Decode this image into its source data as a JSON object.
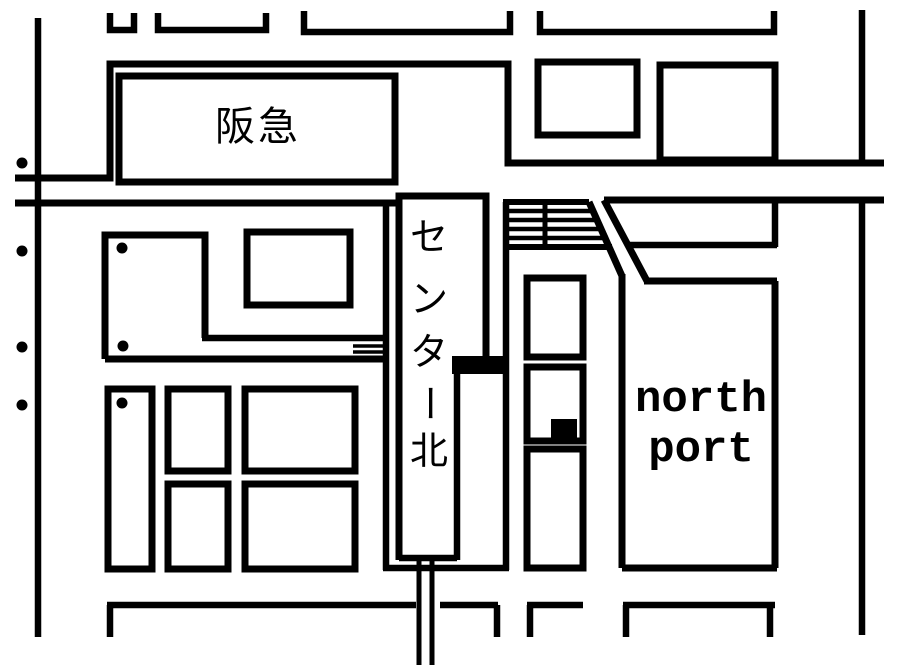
{
  "map": {
    "colors": {
      "background": "#ffffff",
      "ink": "#000000"
    },
    "labels": {
      "hankyu": "阪急",
      "station_name": "センター北",
      "station_chars": [
        "セ",
        "ン",
        "タ",
        "ー",
        "北"
      ],
      "north_port": [
        "north",
        "port"
      ]
    },
    "geometry": {
      "strokes": [
        {
          "name": "top-building-1",
          "d": "M110 13 L110 30 L134 30 L134 13",
          "w": 6.5
        },
        {
          "name": "top-building-2",
          "d": "M158 13 L158 30 L266 30 L266 13",
          "w": 6.5
        },
        {
          "name": "top-building-3",
          "d": "M304 11 L304 32 L510 32 L510 11",
          "w": 6.5
        },
        {
          "name": "top-building-4",
          "d": "M540 11 L540 32 L774 32 L774 11",
          "w": 6.5
        },
        {
          "name": "hankyu-block-outline",
          "d": "M15 178 L110 178 L110 64 L508 64 L508 163 L884 163",
          "w": 7
        },
        {
          "name": "road-edge-south-left",
          "d": "M15 203 L397 203",
          "w": 7
        },
        {
          "name": "road-edge-south-right",
          "d": "M604 200 L884 200",
          "w": 7
        },
        {
          "name": "right-road-line-upper",
          "d": "M862 10 L862 163",
          "w": 6.5
        },
        {
          "name": "right-road-line-lower",
          "d": "M862 200 L862 635",
          "w": 6.5
        },
        {
          "name": "station-block-left",
          "d": "M386 205 L386 570",
          "w": 6.5
        },
        {
          "name": "station-block-bottom",
          "d": "M383 568 L509 568",
          "w": 6.5
        },
        {
          "name": "station-block-right",
          "d": "M506 202 L506 570",
          "w": 6.5
        },
        {
          "name": "station-building-outline",
          "d": "M399 560 L399 196 L486 196 L486 358",
          "w": 7
        },
        {
          "name": "station-building-right-lower",
          "d": "M457 366 L457 560",
          "w": 6.5
        },
        {
          "name": "station-building-bottom",
          "d": "M399 558 L457 558",
          "w": 6.5
        },
        {
          "name": "platform-hatch-top",
          "d": "M503 202 L589 202",
          "w": 6
        },
        {
          "name": "platform-hatch-bottom",
          "d": "M503 247 L612 247",
          "w": 6
        },
        {
          "name": "platform-hatch-divider",
          "d": "M545 202 L545 247",
          "w": 5
        },
        {
          "name": "platform-hatch-stripe-1",
          "d": "M506 211 L592 211",
          "w": 4.5
        },
        {
          "name": "platform-hatch-stripe-2",
          "d": "M506 220 L598 220",
          "w": 4.5
        },
        {
          "name": "platform-hatch-stripe-3",
          "d": "M506 229 L603 229",
          "w": 4.5
        },
        {
          "name": "platform-hatch-stripe-4",
          "d": "M506 238 L608 238",
          "w": 4.5
        },
        {
          "name": "diagonal-road-west",
          "d": "M589 202 L622 276",
          "w": 7
        },
        {
          "name": "north-port-left",
          "d": "M622 274 L622 568",
          "w": 7
        },
        {
          "name": "diagonal-road-east",
          "d": "M604 200 L647 281",
          "w": 7
        },
        {
          "name": "north-port-top",
          "d": "M644 281 L777 281",
          "w": 7
        },
        {
          "name": "bus-strip-right",
          "d": "M775 200 L775 247",
          "w": 6.5
        },
        {
          "name": "bus-strip-bottom",
          "d": "M630 245 L777 245",
          "w": 6.5
        },
        {
          "name": "north-port-right",
          "d": "M775 281 L775 568",
          "w": 7
        },
        {
          "name": "north-port-bottom",
          "d": "M622 568 L777 568",
          "w": 7
        },
        {
          "name": "west-lblock-outline",
          "d": "M105 359 L105 235 L205 235 L205 338",
          "w": 7
        },
        {
          "name": "west-lblock-arm-top",
          "d": "M202 338 L388 338",
          "w": 6.5
        },
        {
          "name": "bridge-bar-1",
          "d": "M353 346 L388 346",
          "w": 3.5
        },
        {
          "name": "bridge-bar-2",
          "d": "M353 352 L388 352",
          "w": 3.5
        },
        {
          "name": "west-lblock-bottom",
          "d": "M105 359 L388 359",
          "w": 7
        },
        {
          "name": "left-road-line",
          "d": "M38 18 L38 637",
          "w": 6.5
        },
        {
          "name": "railway-line-west",
          "d": "M419 558 L419 665",
          "w": 5
        },
        {
          "name": "railway-line-east",
          "d": "M432 558 L432 665",
          "w": 5
        },
        {
          "name": "bottom-block-edge-1",
          "d": "M107 605 L416 605",
          "w": 6.5
        },
        {
          "name": "bottom-block-edge-2",
          "d": "M440 605 L498 605",
          "w": 6.5
        },
        {
          "name": "bottom-block-edge-3",
          "d": "M527 605 L583 605",
          "w": 6.5
        },
        {
          "name": "bottom-block-edge-4",
          "d": "M623 605 L775 605",
          "w": 6.5
        },
        {
          "name": "bottom-block-wall-1",
          "d": "M110 605 L110 637",
          "w": 6.5
        },
        {
          "name": "bottom-block-wall-2",
          "d": "M497 605 L497 637",
          "w": 6.5
        },
        {
          "name": "bottom-block-wall-3",
          "d": "M530 605 L530 637",
          "w": 6.5
        },
        {
          "name": "bottom-block-wall-4",
          "d": "M626 605 L626 637",
          "w": 6.5
        },
        {
          "name": "bottom-block-wall-5",
          "d": "M770 605 L770 637",
          "w": 6.5
        }
      ],
      "rects": [
        {
          "name": "hankyu-building",
          "x": 119,
          "y": 76,
          "w": 276,
          "h": 106,
          "sw": 7
        },
        {
          "name": "building-ne-small",
          "x": 538,
          "y": 62,
          "w": 99,
          "h": 73,
          "sw": 7
        },
        {
          "name": "building-ne-large",
          "x": 660,
          "y": 65,
          "w": 115,
          "h": 95,
          "sw": 7
        },
        {
          "name": "mid-upper-building",
          "x": 247,
          "y": 232,
          "w": 103,
          "h": 73,
          "sw": 7
        },
        {
          "name": "mid-column-building-1",
          "x": 527,
          "y": 278,
          "w": 56,
          "h": 79,
          "sw": 7
        },
        {
          "name": "mid-column-building-2",
          "x": 527,
          "y": 367,
          "w": 56,
          "h": 74,
          "sw": 7
        },
        {
          "name": "mid-column-building-3",
          "x": 527,
          "y": 449,
          "w": 56,
          "h": 119,
          "sw": 7
        },
        {
          "name": "sw-building-tall",
          "x": 108,
          "y": 389,
          "w": 44,
          "h": 180,
          "sw": 7
        },
        {
          "name": "sw-building-2",
          "x": 168,
          "y": 389,
          "w": 60,
          "h": 82,
          "sw": 7
        },
        {
          "name": "sw-building-3",
          "x": 168,
          "y": 484,
          "w": 60,
          "h": 85,
          "sw": 7
        },
        {
          "name": "sw-building-4",
          "x": 245,
          "y": 389,
          "w": 110,
          "h": 82,
          "sw": 7
        },
        {
          "name": "sw-building-5",
          "x": 245,
          "y": 484,
          "w": 110,
          "h": 85,
          "sw": 7
        }
      ],
      "fills": [
        {
          "name": "station-step-joint",
          "x": 452,
          "y": 356,
          "w": 57,
          "h": 18
        },
        {
          "name": "black-square-marker",
          "x": 551,
          "y": 419,
          "w": 26,
          "h": 19
        }
      ],
      "dots": [
        {
          "name": "roadside-dot-1",
          "x": 22,
          "y": 163,
          "r": 5.5
        },
        {
          "name": "roadside-dot-2",
          "x": 22,
          "y": 251,
          "r": 5.5
        },
        {
          "name": "roadside-dot-3",
          "x": 22,
          "y": 347,
          "r": 5.5
        },
        {
          "name": "roadside-dot-4",
          "x": 22,
          "y": 405,
          "r": 5.5
        },
        {
          "name": "block-dot-1",
          "x": 122,
          "y": 248,
          "r": 5.5
        },
        {
          "name": "block-dot-2",
          "x": 123,
          "y": 346,
          "r": 5.5
        },
        {
          "name": "block-dot-3",
          "x": 122,
          "y": 403,
          "r": 5.5
        }
      ],
      "texts": [
        {
          "name": "hankyu-label",
          "bind": "map.labels.hankyu",
          "x": 258,
          "y": 127,
          "size": 40,
          "font": "cjk",
          "ls": 3
        },
        {
          "name": "station-label-char-1",
          "bind": "map.labels.station_chars.0",
          "x": 429,
          "y": 237,
          "size": 38,
          "font": "cjk"
        },
        {
          "name": "station-label-char-2",
          "bind": "map.labels.station_chars.1",
          "x": 429,
          "y": 299,
          "size": 38,
          "font": "cjk"
        },
        {
          "name": "station-label-char-3",
          "bind": "map.labels.station_chars.2",
          "x": 429,
          "y": 352,
          "size": 38,
          "font": "cjk"
        },
        {
          "name": "station-label-char-4",
          "bind": "map.labels.station_chars.3",
          "x": 429,
          "y": 403,
          "size": 38,
          "font": "cjk",
          "rotate": 90
        },
        {
          "name": "station-label-char-5",
          "bind": "map.labels.station_chars.4",
          "x": 429,
          "y": 451,
          "size": 38,
          "font": "cjk"
        },
        {
          "name": "north-port-label-line-1",
          "bind": "map.labels.north_port.0",
          "x": 701,
          "y": 400,
          "size": 44,
          "font": "mono"
        },
        {
          "name": "north-port-label-line-2",
          "bind": "map.labels.north_port.1",
          "x": 701,
          "y": 450,
          "size": 44,
          "font": "mono"
        }
      ]
    }
  }
}
